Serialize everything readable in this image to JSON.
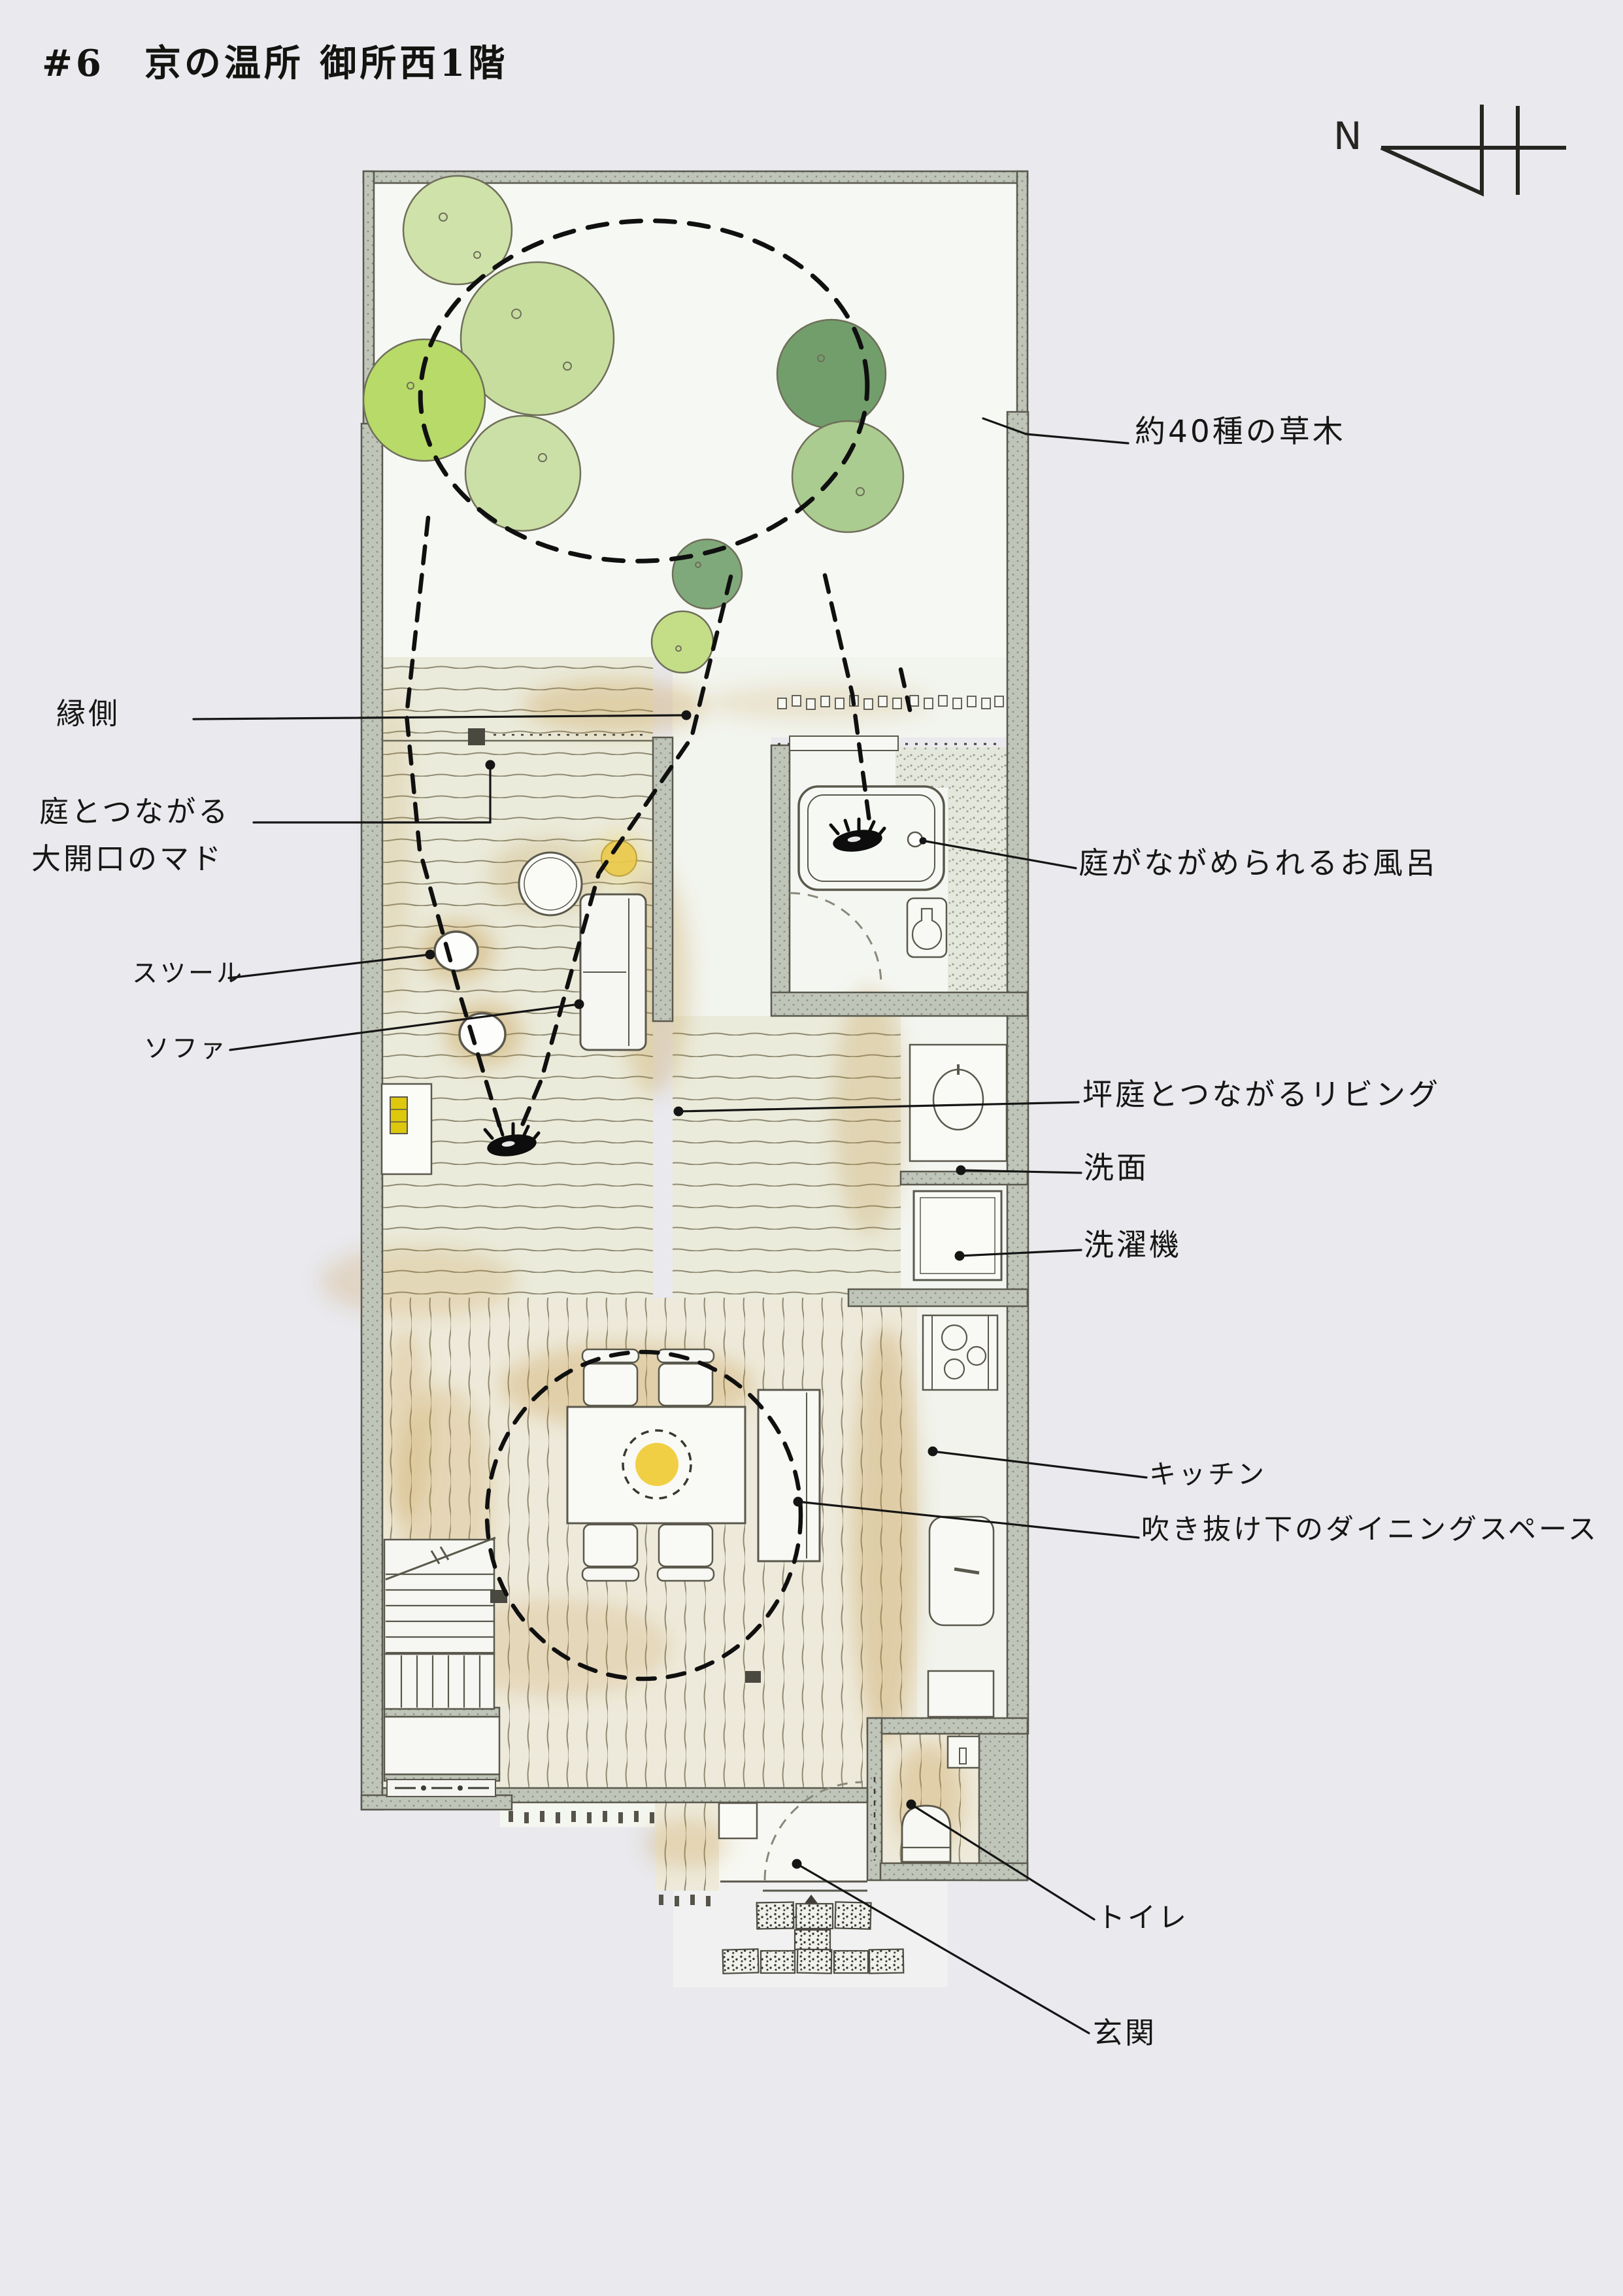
{
  "page": {
    "title": "#6　京の温所 御所西1階",
    "background_color": "#e9e9ee"
  },
  "compass": {
    "label": "N",
    "icon": "north-arrow-icon",
    "direction": "left"
  },
  "labels": {
    "garden_plants": "約40種の草木",
    "engawa": "縁側",
    "mado_line1": "庭とつながる",
    "mado_line2": "大開口のマド",
    "stool": "スツール",
    "sofa": "ソファ",
    "bath": "庭がながめられるお風呂",
    "living": "坪庭とつながるリビング",
    "washbasin": "洗面",
    "washing_machine": "洗濯機",
    "kitchen": "キッチン",
    "dining": "吹き抜け下のダイニングスペース",
    "toilet": "トイレ",
    "entrance": "玄関"
  },
  "icons": {
    "view_marker": "eye-icon",
    "entry_marker": "triangle-up-icon"
  },
  "palette": {
    "wall": "#c0c5b9",
    "wall_line": "#5a594d",
    "floor_living": "#ebebdc",
    "floor_dining": "#eeeadb",
    "plank_line": "#8f8a72",
    "ochre_wash": "#c2933a",
    "tree_greens": [
      "#cfe2a9",
      "#c6dd9e",
      "#b7da69",
      "#cbe0a7",
      "#729e6c",
      "#abcc90",
      "#80a97b",
      "#c4de88"
    ],
    "accent_yellow": "#eac94b",
    "ink": "#151515"
  }
}
